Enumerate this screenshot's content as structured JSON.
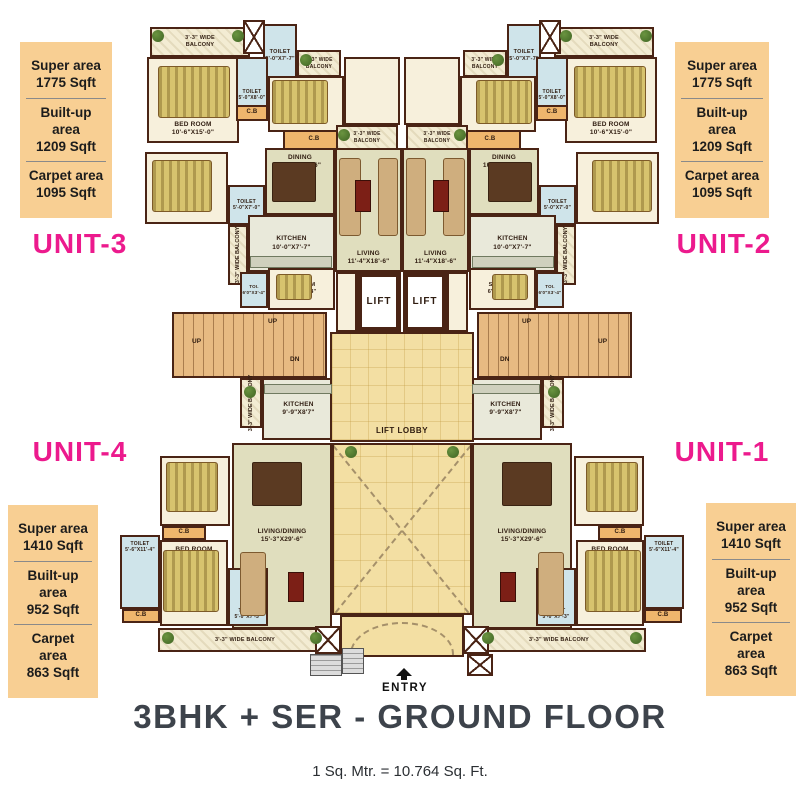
{
  "title": "3BHK + SER - GROUND FLOOR",
  "scale_note": "1 Sq. Mtr. = 10.764 Sq. Ft.",
  "entry_label": "ENTRY",
  "colors": {
    "accent_pink": "#ec1a8d",
    "info_box_bg": "#f8cf93",
    "wall": "#4a2415",
    "lobby_tan": "#f3dfa3",
    "title_gray": "#3d434b"
  },
  "unit_labels": [
    {
      "label": "UNIT-3",
      "x": 10,
      "y": 228
    },
    {
      "label": "UNIT-2",
      "x": 654,
      "y": 228
    },
    {
      "label": "UNIT-4",
      "x": 10,
      "y": 436
    },
    {
      "label": "UNIT-1",
      "x": 652,
      "y": 436
    }
  ],
  "info_boxes": [
    {
      "name": "unit-3-areas",
      "x": 20,
      "y": 42,
      "w": 92,
      "rows": [
        [
          "Super area",
          "1775 Sqft"
        ],
        [
          "Built-up area",
          "1209 Sqft"
        ],
        [
          "Carpet area",
          "1095 Sqft"
        ]
      ]
    },
    {
      "name": "unit-2-areas",
      "x": 675,
      "y": 42,
      "w": 94,
      "rows": [
        [
          "Super area",
          "1775 Sqft"
        ],
        [
          "Built-up area",
          "1209 Sqft"
        ],
        [
          "Carpet area",
          "1095 Sqft"
        ]
      ]
    },
    {
      "name": "unit-4-areas",
      "x": 8,
      "y": 505,
      "w": 90,
      "rows": [
        [
          "Super area",
          "1410 Sqft"
        ],
        [
          "Built-up area",
          "952 Sqft"
        ],
        [
          "Carpet area",
          "863 Sqft"
        ]
      ]
    },
    {
      "name": "unit-1-areas",
      "x": 706,
      "y": 503,
      "w": 90,
      "rows": [
        [
          "Super area",
          "1410 Sqft"
        ],
        [
          "Built-up area",
          "952 Sqft"
        ],
        [
          "Carpet area",
          "863 Sqft"
        ]
      ]
    }
  ],
  "plan": {
    "mirror_axis": 402,
    "rooms": [
      {
        "n": "balcony-top",
        "x": 150,
        "y": 27,
        "w": 100,
        "h": 30,
        "c": "balc",
        "m": true,
        "lines": [
          "3'-3\" WIDE",
          "BALCONY"
        ],
        "fs": 5.5
      },
      {
        "n": "shaft-top",
        "x": 243,
        "y": 20,
        "w": 22,
        "h": 34,
        "c": "shaft",
        "m": true
      },
      {
        "n": "toilet-top",
        "x": 263,
        "y": 24,
        "w": 34,
        "h": 64,
        "c": "blue",
        "m": true,
        "lines": [
          "TOILET",
          "5'-0\"X7'-7\""
        ],
        "fs": 5.5
      },
      {
        "n": "bedroom-1",
        "x": 147,
        "y": 57,
        "w": 92,
        "h": 86,
        "c": "cream",
        "m": true,
        "la": "bottom",
        "lines": [
          "BED ROOM",
          "10'-6\"X15'-0\""
        ]
      },
      {
        "n": "toilet-2",
        "x": 236,
        "y": 57,
        "w": 32,
        "h": 50,
        "c": "blue",
        "m": true,
        "la": "bottom",
        "lines": [
          "TOILET",
          "5'-0\"X8'-0\""
        ],
        "fs": 5
      },
      {
        "n": "cb-1",
        "x": 236,
        "y": 105,
        "w": 32,
        "h": 16,
        "c": "cb",
        "m": true,
        "lines": [
          "C.B"
        ]
      },
      {
        "n": "bedroom-2",
        "x": 268,
        "y": 76,
        "w": 76,
        "h": 56,
        "c": "cream",
        "m": true,
        "lines": [
          "BED ROOM",
          "11'-2\"X11'-0\""
        ]
      },
      {
        "n": "cb-2",
        "x": 283,
        "y": 130,
        "w": 62,
        "h": 20,
        "c": "cb",
        "m": true,
        "lines": [
          "C.B"
        ]
      },
      {
        "n": "balcony-a",
        "x": 297,
        "y": 50,
        "w": 44,
        "h": 27,
        "c": "balc",
        "m": true,
        "lines": [
          "3'-3\" WIDE",
          "BALCONY"
        ],
        "fs": 5
      },
      {
        "n": "hall-top",
        "x": 344,
        "y": 57,
        "w": 56,
        "h": 68,
        "c": "cream",
        "m": true
      },
      {
        "n": "balcony-b",
        "x": 336,
        "y": 125,
        "w": 62,
        "h": 25,
        "c": "balc",
        "m": true,
        "lines": [
          "3'-3\" WIDE",
          "BALCONY"
        ],
        "fs": 5
      },
      {
        "n": "bedroom-3",
        "x": 145,
        "y": 152,
        "w": 83,
        "h": 72,
        "c": "cream",
        "m": true,
        "lines": [
          "BED ROOM",
          "10'-6\"X11'-6\""
        ]
      },
      {
        "n": "toilet-3",
        "x": 228,
        "y": 185,
        "w": 37,
        "h": 40,
        "c": "blue",
        "m": true,
        "lines": [
          "TOILET",
          "5'-0\"X7'-0\""
        ],
        "fs": 5
      },
      {
        "n": "dining",
        "x": 265,
        "y": 148,
        "w": 70,
        "h": 67,
        "c": "sage",
        "m": true,
        "la": "top",
        "lines": [
          "DINING",
          "10'-6\"X10'-6\""
        ]
      },
      {
        "n": "living",
        "x": 335,
        "y": 148,
        "w": 67,
        "h": 124,
        "c": "sage",
        "m": true,
        "la": "bottom",
        "lines": [
          "LIVING",
          "11'-4\"X18'-6\""
        ]
      },
      {
        "n": "kitchen",
        "x": 248,
        "y": 215,
        "w": 87,
        "h": 57,
        "c": "kitchen",
        "m": true,
        "lines": [
          "KITCHEN",
          "10'-0\"X7'-7\""
        ]
      },
      {
        "n": "balcony-side-1",
        "x": 228,
        "y": 225,
        "w": 20,
        "h": 60,
        "c": "balc",
        "m": true,
        "vl": "3'-3\" WIDE BALCONY"
      },
      {
        "n": "toi-small",
        "x": 240,
        "y": 272,
        "w": 28,
        "h": 36,
        "c": "blue",
        "m": true,
        "lines": [
          "TOI.",
          "6'0\"X3'-4\""
        ],
        "fs": 4.5
      },
      {
        "n": "sr-room",
        "x": 268,
        "y": 268,
        "w": 67,
        "h": 42,
        "c": "cream",
        "m": true,
        "lines": [
          "SR.ROOM",
          "6'-7\"X6'-4\""
        ],
        "fs": 5.5
      },
      {
        "n": "foyer",
        "x": 336,
        "y": 272,
        "w": 21,
        "h": 60,
        "c": "cream",
        "m": true
      },
      {
        "n": "staircase",
        "x": 172,
        "y": 312,
        "w": 155,
        "h": 66,
        "c": "stairs",
        "m": true
      },
      {
        "n": "balcony-side-2",
        "x": 240,
        "y": 378,
        "w": 22,
        "h": 50,
        "c": "balc",
        "m": true,
        "vl": "3'-3\" WIDE BALCONY"
      },
      {
        "n": "kitchen-lower",
        "x": 262,
        "y": 378,
        "w": 73,
        "h": 62,
        "c": "kitchen",
        "m": true,
        "lines": [
          "KITCHEN",
          "9'-9\"X8'7\""
        ]
      },
      {
        "n": "living-dining",
        "x": 232,
        "y": 443,
        "w": 100,
        "h": 186,
        "c": "sage",
        "m": true,
        "lines": [
          "LIVING/DINING",
          "15'-3\"X29'-6\""
        ]
      },
      {
        "n": "bedroom-a",
        "x": 160,
        "y": 456,
        "w": 70,
        "h": 70,
        "c": "cream",
        "m": true,
        "lines": [
          "BED ROOM",
          "10'-0\"X11'-9\""
        ]
      },
      {
        "n": "cb-3",
        "x": 162,
        "y": 526,
        "w": 44,
        "h": 14,
        "c": "cb",
        "m": true,
        "lines": [
          "C.B"
        ]
      },
      {
        "n": "bedroom-b",
        "x": 160,
        "y": 540,
        "w": 68,
        "h": 86,
        "c": "cream",
        "m": true,
        "la": "top",
        "lines": [
          "BED ROOM",
          "10'-4\"X13'-5\""
        ]
      },
      {
        "n": "toilet-side",
        "x": 120,
        "y": 535,
        "w": 40,
        "h": 74,
        "c": "blue",
        "m": true,
        "la": "top",
        "lines": [
          "TOILET",
          "5'-6\"X11'-4\""
        ],
        "fs": 5
      },
      {
        "n": "cb-4",
        "x": 122,
        "y": 609,
        "w": 38,
        "h": 14,
        "c": "cb",
        "m": true,
        "lines": [
          "C.B"
        ]
      },
      {
        "n": "toilet-lower",
        "x": 228,
        "y": 568,
        "w": 40,
        "h": 58,
        "c": "blue",
        "m": true,
        "la": "bottom",
        "lines": [
          "TOILET",
          "5'-0\"X7'-3\""
        ],
        "fs": 5
      },
      {
        "n": "balcony-bottom",
        "x": 158,
        "y": 628,
        "w": 174,
        "h": 24,
        "c": "balc",
        "m": true,
        "lines": [
          "3'-3\" WIDE BALCONY"
        ],
        "fs": 5.5
      },
      {
        "n": "lift-lobby",
        "x": 330,
        "y": 332,
        "w": 144,
        "h": 110,
        "c": "tan",
        "la": "bottom",
        "lines": [
          "LIFT LOBBY"
        ]
      },
      {
        "n": "courtyard",
        "x": 332,
        "y": 443,
        "w": 140,
        "h": 172,
        "c": "court"
      },
      {
        "n": "entry-canopy",
        "x": 340,
        "y": 615,
        "w": 124,
        "h": 42,
        "c": "canopy"
      },
      {
        "n": "lift",
        "x": 357,
        "y": 272,
        "w": 44,
        "h": 60,
        "c": "lift",
        "m": true,
        "lines": [
          "LIFT"
        ]
      },
      {
        "n": "entry-shaft",
        "x": 315,
        "y": 626,
        "w": 26,
        "h": 28,
        "c": "shaft",
        "m": true
      },
      {
        "n": "entry-steps",
        "x": 310,
        "y": 654,
        "w": 32,
        "h": 22,
        "c": "gsteps"
      },
      {
        "n": "entry-steps-2",
        "x": 342,
        "y": 648,
        "w": 22,
        "h": 26,
        "c": "gsteps"
      },
      {
        "n": "entry-shaft-2",
        "x": 467,
        "y": 654,
        "w": 26,
        "h": 22,
        "c": "shaft"
      }
    ],
    "furniture": [
      {
        "n": "bed",
        "t": "bed",
        "x": 158,
        "y": 66,
        "w": 72,
        "h": 52,
        "m": true
      },
      {
        "n": "bed",
        "t": "bed",
        "x": 272,
        "y": 80,
        "w": 56,
        "h": 44,
        "m": true
      },
      {
        "n": "bed",
        "t": "bed",
        "x": 152,
        "y": 160,
        "w": 60,
        "h": 52,
        "m": true
      },
      {
        "n": "bed",
        "t": "bed",
        "x": 276,
        "y": 274,
        "w": 36,
        "h": 26,
        "m": true
      },
      {
        "n": "bed",
        "t": "bed",
        "x": 166,
        "y": 462,
        "w": 52,
        "h": 50,
        "m": true
      },
      {
        "n": "bed",
        "t": "bed",
        "x": 163,
        "y": 550,
        "w": 56,
        "h": 62,
        "m": true
      },
      {
        "n": "dining-table",
        "t": "tbl",
        "x": 272,
        "y": 162,
        "w": 44,
        "h": 40,
        "m": true
      },
      {
        "n": "dining-table",
        "t": "tbl",
        "x": 252,
        "y": 462,
        "w": 50,
        "h": 44,
        "m": true
      },
      {
        "n": "sofa",
        "t": "sofa",
        "x": 339,
        "y": 158,
        "w": 22,
        "h": 78,
        "m": true
      },
      {
        "n": "sofa",
        "t": "sofa",
        "x": 378,
        "y": 158,
        "w": 20,
        "h": 78,
        "m": true
      },
      {
        "n": "sofa",
        "t": "sofa",
        "x": 240,
        "y": 552,
        "w": 26,
        "h": 64,
        "m": true
      },
      {
        "n": "tv-unit",
        "t": "tvu",
        "x": 355,
        "y": 180,
        "w": 16,
        "h": 32,
        "m": true
      },
      {
        "n": "tv-unit",
        "t": "tvu",
        "x": 288,
        "y": 572,
        "w": 16,
        "h": 30,
        "m": true
      },
      {
        "n": "kitchen-counter",
        "t": "cnt",
        "x": 250,
        "y": 256,
        "w": 82,
        "h": 12,
        "m": true
      },
      {
        "n": "kitchen-counter",
        "t": "cnt",
        "x": 264,
        "y": 384,
        "w": 68,
        "h": 10,
        "m": true
      }
    ],
    "plants": [
      {
        "x": 152,
        "y": 30,
        "m": true
      },
      {
        "x": 232,
        "y": 30,
        "m": true
      },
      {
        "x": 300,
        "y": 54,
        "m": true
      },
      {
        "x": 338,
        "y": 129,
        "m": true
      },
      {
        "x": 244,
        "y": 386,
        "m": true
      },
      {
        "x": 162,
        "y": 632,
        "m": true
      },
      {
        "x": 310,
        "y": 632,
        "m": true
      },
      {
        "x": 345,
        "y": 446,
        "m": true
      }
    ],
    "texts": [
      {
        "t": "UP",
        "x": 268,
        "y": 318,
        "m": true
      },
      {
        "t": "UP",
        "x": 192,
        "y": 338,
        "m": true
      },
      {
        "t": "DN",
        "x": 290,
        "y": 356,
        "m": true
      }
    ]
  }
}
